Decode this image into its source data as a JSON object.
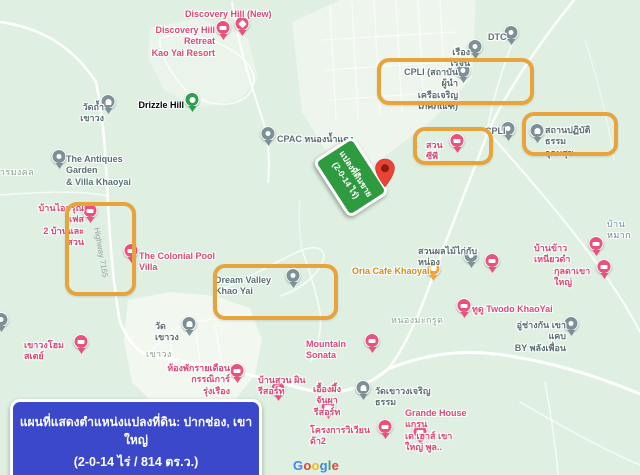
{
  "map": {
    "sign": {
      "line1": "แปลงที่ดินขาย",
      "line2": "(2-0-14 ไร่)"
    },
    "banner": {
      "line1": "แผนที่แสดงตำแหน่งแปลงที่ดิน: ปากช่อง, เขาใหญ่",
      "line2": "(2-0-14 ไร่ / 814 ตร.ว.)"
    },
    "road_label": {
      "text": "Highway 7165"
    },
    "attribution": {
      "text": "Google",
      "letter_colors": [
        "#4285F4",
        "#EA4335",
        "#FBBC05",
        "#4285F4",
        "#34A853",
        "#EA4335"
      ]
    },
    "colors": {
      "highlight": "#e8a43c",
      "sign_green": "#2f9b41",
      "banner_blue": "#3b48c9",
      "pin_pink": "#e9527c",
      "pin_gray": "#7d9097",
      "pin_green": "#2e9e4f",
      "pin_orange": "#f2a33b",
      "dest_red": "#ea4335",
      "map_bg": "#dff0e2"
    },
    "highlights": [
      {
        "name": "highlight-baan-i-arun",
        "x": 65,
        "y": 202,
        "w": 63,
        "h": 86
      },
      {
        "name": "highlight-dream-valley",
        "x": 213,
        "y": 264,
        "w": 117,
        "h": 48
      },
      {
        "name": "highlight-cpli-institute",
        "x": 377,
        "y": 58,
        "w": 149,
        "h": 39
      },
      {
        "name": "highlight-suan-cp",
        "x": 413,
        "y": 127,
        "w": 72,
        "h": 30
      },
      {
        "name": "highlight-meditation-center",
        "x": 522,
        "y": 112,
        "w": 88,
        "h": 36
      }
    ],
    "markers": [
      {
        "name": "discovery-hill-new",
        "text": "Discovery Hill (New)",
        "color": "pink",
        "icon": "scenic",
        "pin": {
          "x": 242,
          "y": 36
        },
        "label": {
          "x": 185,
          "y": 9,
          "w": 90,
          "align": "left"
        }
      },
      {
        "name": "discovery-hill-retreat",
        "text": "Discovery Hill Retreat\nKao Yai Resort",
        "color": "pink",
        "icon": "lodging",
        "pin": {
          "x": 223,
          "y": 40
        },
        "label": {
          "x": 135,
          "y": 25,
          "w": 80,
          "align": "right"
        }
      },
      {
        "name": "drizzle-hill",
        "text": "Drizzle Hill",
        "color": "green",
        "icon": "park",
        "pin": {
          "x": 192,
          "y": 112
        },
        "label": {
          "x": 136,
          "y": 100,
          "w": 48,
          "align": "right"
        }
      },
      {
        "name": "wat-tham-khao-wong",
        "text": "วัดถ้ำเขาวง",
        "color": "gray",
        "icon": "temple",
        "pin": {
          "x": 108,
          "y": 114
        },
        "label": {
          "x": 68,
          "y": 102,
          "w": 36,
          "align": "right"
        }
      },
      {
        "name": "antiques-garden-villa",
        "text": "The Antiques Garden\n& Villa Khaoyai",
        "color": "gray",
        "icon": "poi",
        "pin": {
          "x": 59,
          "y": 169
        },
        "label": {
          "x": 66,
          "y": 154,
          "w": 72,
          "align": "left"
        }
      },
      {
        "name": "baan-i-arun-phase2",
        "text": "บ้านไออรุณ เฟส\n2 บ้านและสวน",
        "color": "pink",
        "icon": "lodging",
        "pin": {
          "x": 90,
          "y": 223
        },
        "label": {
          "x": 34,
          "y": 203,
          "w": 50,
          "align": "right"
        }
      },
      {
        "name": "colonial-pool-villa",
        "text": "The Colonial Pool Villa",
        "color": "pink",
        "icon": "lodging",
        "pin": {
          "x": 131,
          "y": 263
        },
        "label": {
          "x": 139,
          "y": 251,
          "w": 88,
          "align": "left"
        }
      },
      {
        "name": "dream-valley-khao-yai",
        "text": "Dream Valley Khao Yai",
        "color": "gray",
        "icon": "poi",
        "pin": {
          "x": 293,
          "y": 288
        },
        "label": {
          "x": 215,
          "y": 275,
          "w": 78,
          "align": "left"
        }
      },
      {
        "name": "oria-cafe-khaoyai",
        "text": "Oria Cafe Khaoyai",
        "color": "orange",
        "icon": "cafe",
        "pin": {
          "x": 433,
          "y": 281
        },
        "label": {
          "x": 352,
          "y": 266,
          "w": 78,
          "align": "left"
        }
      },
      {
        "name": "fruit-garden-kai-nong",
        "text": "สวนผลไม้ไก่กับหน่อง",
        "color": "gray",
        "icon": "poi",
        "pin": {
          "x": 471,
          "y": 268
        },
        "label": {
          "x": 418,
          "y": 246,
          "w": 68,
          "align": "left"
        }
      },
      {
        "name": "unnamed-lodging",
        "text": "",
        "color": "pink",
        "icon": "lodging",
        "pin": {
          "x": 492,
          "y": 273
        }
      },
      {
        "name": "baan-khao-niao-dam",
        "text": "บ้านข้าวเหนียวดำ",
        "color": "pink",
        "icon": "lodging",
        "pin": {
          "x": 596,
          "y": 256
        },
        "label": {
          "x": 534,
          "y": 243,
          "w": 58,
          "align": "left"
        }
      },
      {
        "name": "kulda-khaoyai",
        "text": "กุลดาเขาใหญ่",
        "color": "pink",
        "icon": "lodging",
        "pin": {
          "x": 604,
          "y": 279
        },
        "label": {
          "x": 554,
          "y": 266,
          "w": 44,
          "align": "left"
        }
      },
      {
        "name": "cpli-institute",
        "text": "CPLI (สถาบันผู้นำ\nเครือเจริญโภคภัณฑ์)",
        "color": "gray",
        "icon": "poi",
        "pin": {
          "x": 463,
          "y": 83
        },
        "label": {
          "x": 398,
          "y": 67,
          "w": 60,
          "align": "right"
        }
      },
      {
        "name": "rueang-rot",
        "text": "เรืองโรจน์",
        "color": "gray",
        "icon": "poi",
        "pin": {
          "x": 475,
          "y": 59
        },
        "label": {
          "x": 432,
          "y": 47,
          "w": 38,
          "align": "right"
        }
      },
      {
        "name": "dtc",
        "text": "DTC",
        "color": "gray",
        "icon": "poi",
        "pin": {
          "x": 511,
          "y": 45
        },
        "label": {
          "x": 488,
          "y": 32,
          "w": 22,
          "align": "left"
        }
      },
      {
        "name": "suan-cp",
        "text": "สวน ซีพี",
        "color": "pink",
        "icon": "lodging",
        "pin": {
          "x": 457,
          "y": 153
        },
        "label": {
          "x": 426,
          "y": 140,
          "w": 28,
          "align": "left"
        }
      },
      {
        "name": "cpli-poi",
        "text": "CPLI",
        "color": "gray",
        "icon": "poi",
        "pin": {
          "x": 508,
          "y": 141
        },
        "label": {
          "x": 485,
          "y": 126,
          "w": 22,
          "align": "left"
        }
      },
      {
        "name": "meditation-center-udomsuk",
        "text": "สถานปฏิบัติธรรม\nอุดมสุข",
        "color": "gray",
        "icon": "temple",
        "pin": {
          "x": 537,
          "y": 143
        },
        "label": {
          "x": 545,
          "y": 125,
          "w": 58,
          "align": "left"
        }
      },
      {
        "name": "cpac-nong-nam-daeng",
        "text": "CPAC หนองน้ำแดง",
        "color": "gray",
        "icon": "poi",
        "pin": {
          "x": 268,
          "y": 146
        },
        "label": {
          "x": 277,
          "y": 134,
          "w": 82,
          "align": "left"
        }
      },
      {
        "name": "twodo-khaoyai",
        "text": "ทูดู Twodo KhaoYai",
        "color": "pink",
        "icon": "lodging",
        "pin": {
          "x": 464,
          "y": 318
        },
        "label": {
          "x": 472,
          "y": 304,
          "w": 82,
          "align": "left"
        }
      },
      {
        "name": "u-chang-kan",
        "text": "อู่ช่างกัน เขาแคบ\nBY พลังเพื่อน",
        "color": "gray",
        "icon": "poi",
        "pin": {
          "x": 571,
          "y": 336
        },
        "label": {
          "x": 512,
          "y": 320,
          "w": 54,
          "align": "right"
        }
      },
      {
        "name": "mountain-sonata",
        "text": "Mountain Sonata",
        "color": "pink",
        "icon": "lodging",
        "pin": {
          "x": 372,
          "y": 353
        },
        "label": {
          "x": 306,
          "y": 339,
          "w": 62,
          "align": "left"
        }
      },
      {
        "name": "khao-wong-homestay",
        "text": "เขาวงโฮมสเตย์",
        "color": "pink",
        "icon": "lodging",
        "pin": {
          "x": 81,
          "y": 354
        },
        "label": {
          "x": 24,
          "y": 340,
          "w": 52,
          "align": "left"
        }
      },
      {
        "name": "wat-khao-wong",
        "text": "วัดเขาวง",
        "color": "gray",
        "icon": "temple",
        "pin": {
          "x": 189,
          "y": 336
        },
        "label": {
          "x": 155,
          "y": 321,
          "w": 30,
          "align": "left"
        }
      },
      {
        "name": "monthly-room-kannika",
        "text": "ห้องพักรายเดือน\nกรรณิการ์รุ่งเรือง",
        "color": "pink",
        "icon": "lodging",
        "pin": {
          "x": 237,
          "y": 383
        },
        "label": {
          "x": 166,
          "y": 363,
          "w": 64,
          "align": "right"
        }
      },
      {
        "name": "baan-suan-phin-resort",
        "text": "บ้านสวน ผิน รีสอร์ท",
        "color": "pink",
        "icon": "lodging",
        "pin": {
          "x": 278,
          "y": 401
        },
        "label": {
          "x": 258,
          "y": 375,
          "w": 62,
          "align": "left"
        }
      },
      {
        "name": "ueang-phueng-chanpha-resort",
        "text": "เอื้องผึ้ง\nจันผารีสอร์ท",
        "color": "pink",
        "icon": "lodging",
        "pin": {
          "x": 328,
          "y": 419
        },
        "label": {
          "x": 304,
          "y": 384,
          "w": 46,
          "align": "center"
        }
      },
      {
        "name": "wat-khao-wong-charoentham",
        "text": "วัดเขาวงเจริญธรรม",
        "color": "gray",
        "icon": "temple",
        "pin": {
          "x": 363,
          "y": 400
        },
        "label": {
          "x": 375,
          "y": 386,
          "w": 64,
          "align": "left"
        }
      },
      {
        "name": "wiwianda-project",
        "text": "โครงการวิเวียนด้า2",
        "color": "pink",
        "icon": "lodging",
        "pin": {
          "x": 385,
          "y": 439
        },
        "label": {
          "x": 310,
          "y": 425,
          "w": 66,
          "align": "left"
        }
      },
      {
        "name": "grande-house-khaoyai",
        "text": "Grande House แกรน\nเด เฮาส์ เขาใหญ่ พูล..",
        "color": "pink",
        "icon": "lodging",
        "pin": {
          "x": 420,
          "y": 444
        },
        "label": {
          "x": 405,
          "y": 408,
          "w": 64,
          "align": "left"
        }
      },
      {
        "name": "edge-cut-poi",
        "text": "",
        "color": "gray",
        "icon": "poi",
        "pin": {
          "x": 1,
          "y": 332
        }
      }
    ],
    "area_labels": [
      {
        "name": "area-tharn-mongkol",
        "text": "ธารมงคล",
        "x": -6,
        "y": 167,
        "style": "area"
      },
      {
        "name": "area-nong-makrut",
        "text": "หนองมะกรูด",
        "x": 391,
        "y": 315,
        "style": "area"
      },
      {
        "name": "area-khao-wong",
        "text": "เขาวง",
        "x": 146,
        "y": 349,
        "style": "area"
      },
      {
        "name": "area-baan-mak",
        "text": "บ้านหมาก",
        "x": 607,
        "y": 219,
        "style": "town"
      }
    ]
  }
}
